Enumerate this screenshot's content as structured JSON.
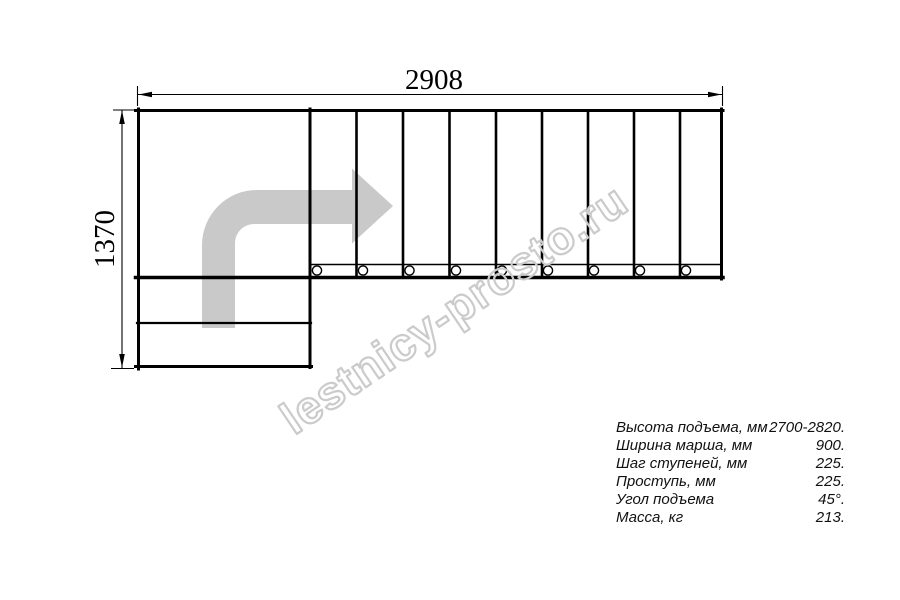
{
  "drawing_title": "staircase-floor-plan",
  "dimensions": {
    "width_mm": "2908",
    "height_mm": "1370"
  },
  "watermark": {
    "text": "lestnicy-prosto.ru"
  },
  "specs": {
    "rows": [
      {
        "label": "Высота подъема, мм",
        "value": "2700-2820."
      },
      {
        "label": "Ширина марша, мм",
        "value": "900."
      },
      {
        "label": "Шаг ступеней, мм",
        "value": "225."
      },
      {
        "label": "Проступь, мм",
        "value": "225."
      },
      {
        "label": "Угол подъема",
        "value": "45°."
      },
      {
        "label": "Масса, кг",
        "value": "213."
      }
    ]
  },
  "stair_structure": {
    "tread_count": 9,
    "baluster_count": 9,
    "bottom_step_count": 2,
    "turn": "left-to-right 90 degree turn"
  },
  "colors": {
    "line": "#000000",
    "arrow_fill": "#c9c9c9",
    "watermark_stroke": "#cbcbcb",
    "background": "#ffffff",
    "spec_text": "#111111"
  }
}
